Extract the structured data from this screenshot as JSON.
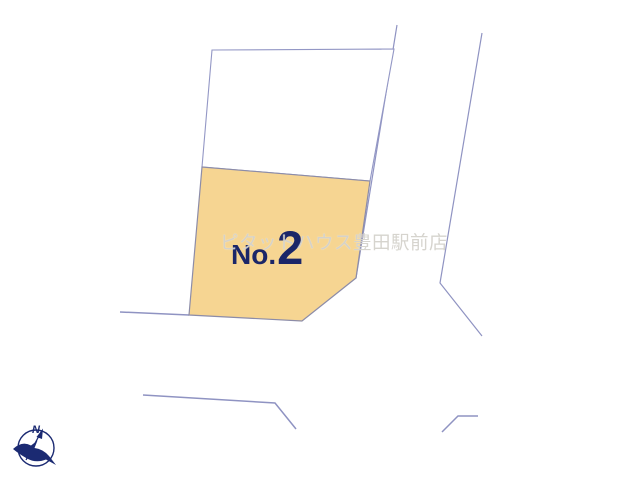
{
  "diagram": {
    "background_color": "#FFFFFF",
    "line_color": "#8F93C2",
    "parcels": {
      "highlighted": {
        "label_prefix": "No.",
        "label_number": "2",
        "fill_color": "#F6D592",
        "label_color": "#1B2668"
      },
      "adjacent": {
        "fill_color": "#FFFFFF"
      }
    },
    "watermark": {
      "text": "ピタットハウス豊田駅前店",
      "color": "#D4D2CC"
    },
    "compass": {
      "north_label": "N",
      "color": "#1B2A72"
    }
  }
}
